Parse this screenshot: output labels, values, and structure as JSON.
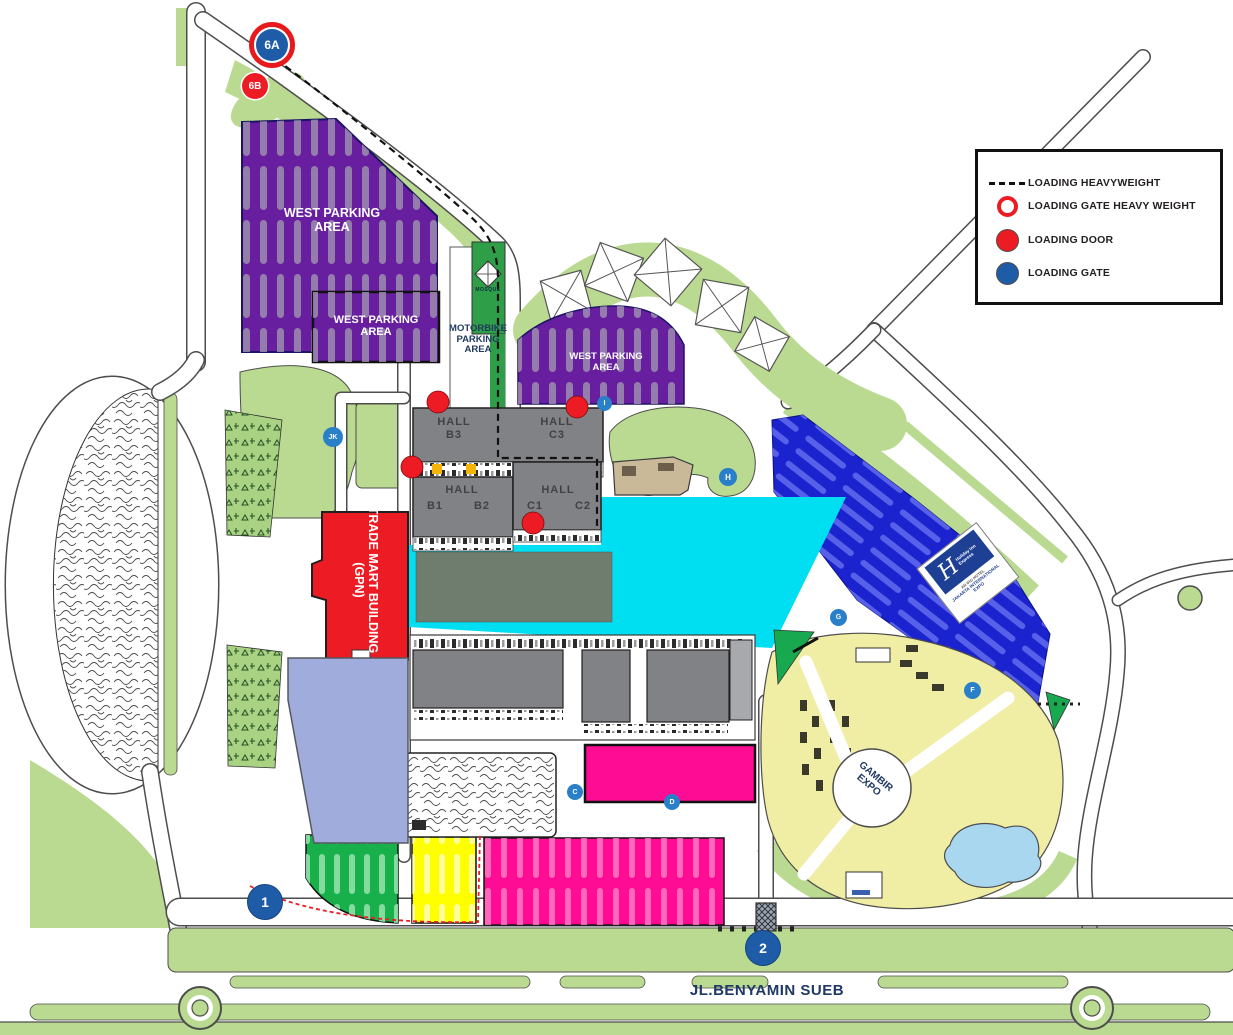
{
  "legend": {
    "items": [
      {
        "symbol": "dashed-line",
        "label": "LOADING HEAVYWEIGHT"
      },
      {
        "symbol": "red-ring",
        "label": "LOADING GATE HEAVY WEIGHT"
      },
      {
        "symbol": "red-circle",
        "label": "LOADING DOOR"
      },
      {
        "symbol": "blue-circle",
        "label": "LOADING GATE"
      }
    ]
  },
  "areas": {
    "west_parking_large": "WEST PARKING AREA",
    "west_parking_inner": "WEST PARKING AREA",
    "west_parking_mid": "WEST PARKING AREA",
    "motorbike": "MOTORBIKE PARKING AREA",
    "mosque": "MOSQUE",
    "trade_mart": {
      "line1": "TRADE MART BUILDING",
      "line2": "(GPN)"
    },
    "gambir": {
      "line1": "GAMBIR",
      "line2": "EXPO"
    },
    "halls": {
      "b3": {
        "word": "HALL",
        "code": "B3"
      },
      "c3": {
        "word": "HALL",
        "code": "C3"
      },
      "b12": {
        "word": "HALL",
        "b1": "B1",
        "b2": "B2"
      },
      "c12": {
        "word": "HALL",
        "c1": "C1",
        "c2": "C2"
      }
    }
  },
  "road_label": "JL.BENYAMIN SUEB",
  "markers": {
    "gate6a": "6A",
    "door6b": "6B",
    "gate1": "1",
    "gate2": "2",
    "jk": "JK",
    "i": "I",
    "h": "H",
    "c": "C",
    "d": "D",
    "g": "G",
    "f": "F"
  },
  "hotel": {
    "brand1": "Holiday Inn",
    "brand2": "Express",
    "sub1": "AN IHG HOTEL",
    "sub2": "JAKARTA INTERNATIONAL EXPO"
  },
  "colors": {
    "landscape": "#b9da90",
    "purple": "#671fa0",
    "hall_gray": "#808285",
    "red": "#ed1c24",
    "cyan": "#00dff2",
    "magenta": "#ff0c94",
    "yellow": "#ffff00",
    "parking_green": "#17b04b",
    "blue_parking": "#1b23cf",
    "gate_blue": "#1e5ca8",
    "lavender": "#a0addc",
    "gambir_yellow": "#f0eda4",
    "pond_blue": "#a9d7ef",
    "olive": "#6e7d6e",
    "tan": "#c9b999"
  }
}
